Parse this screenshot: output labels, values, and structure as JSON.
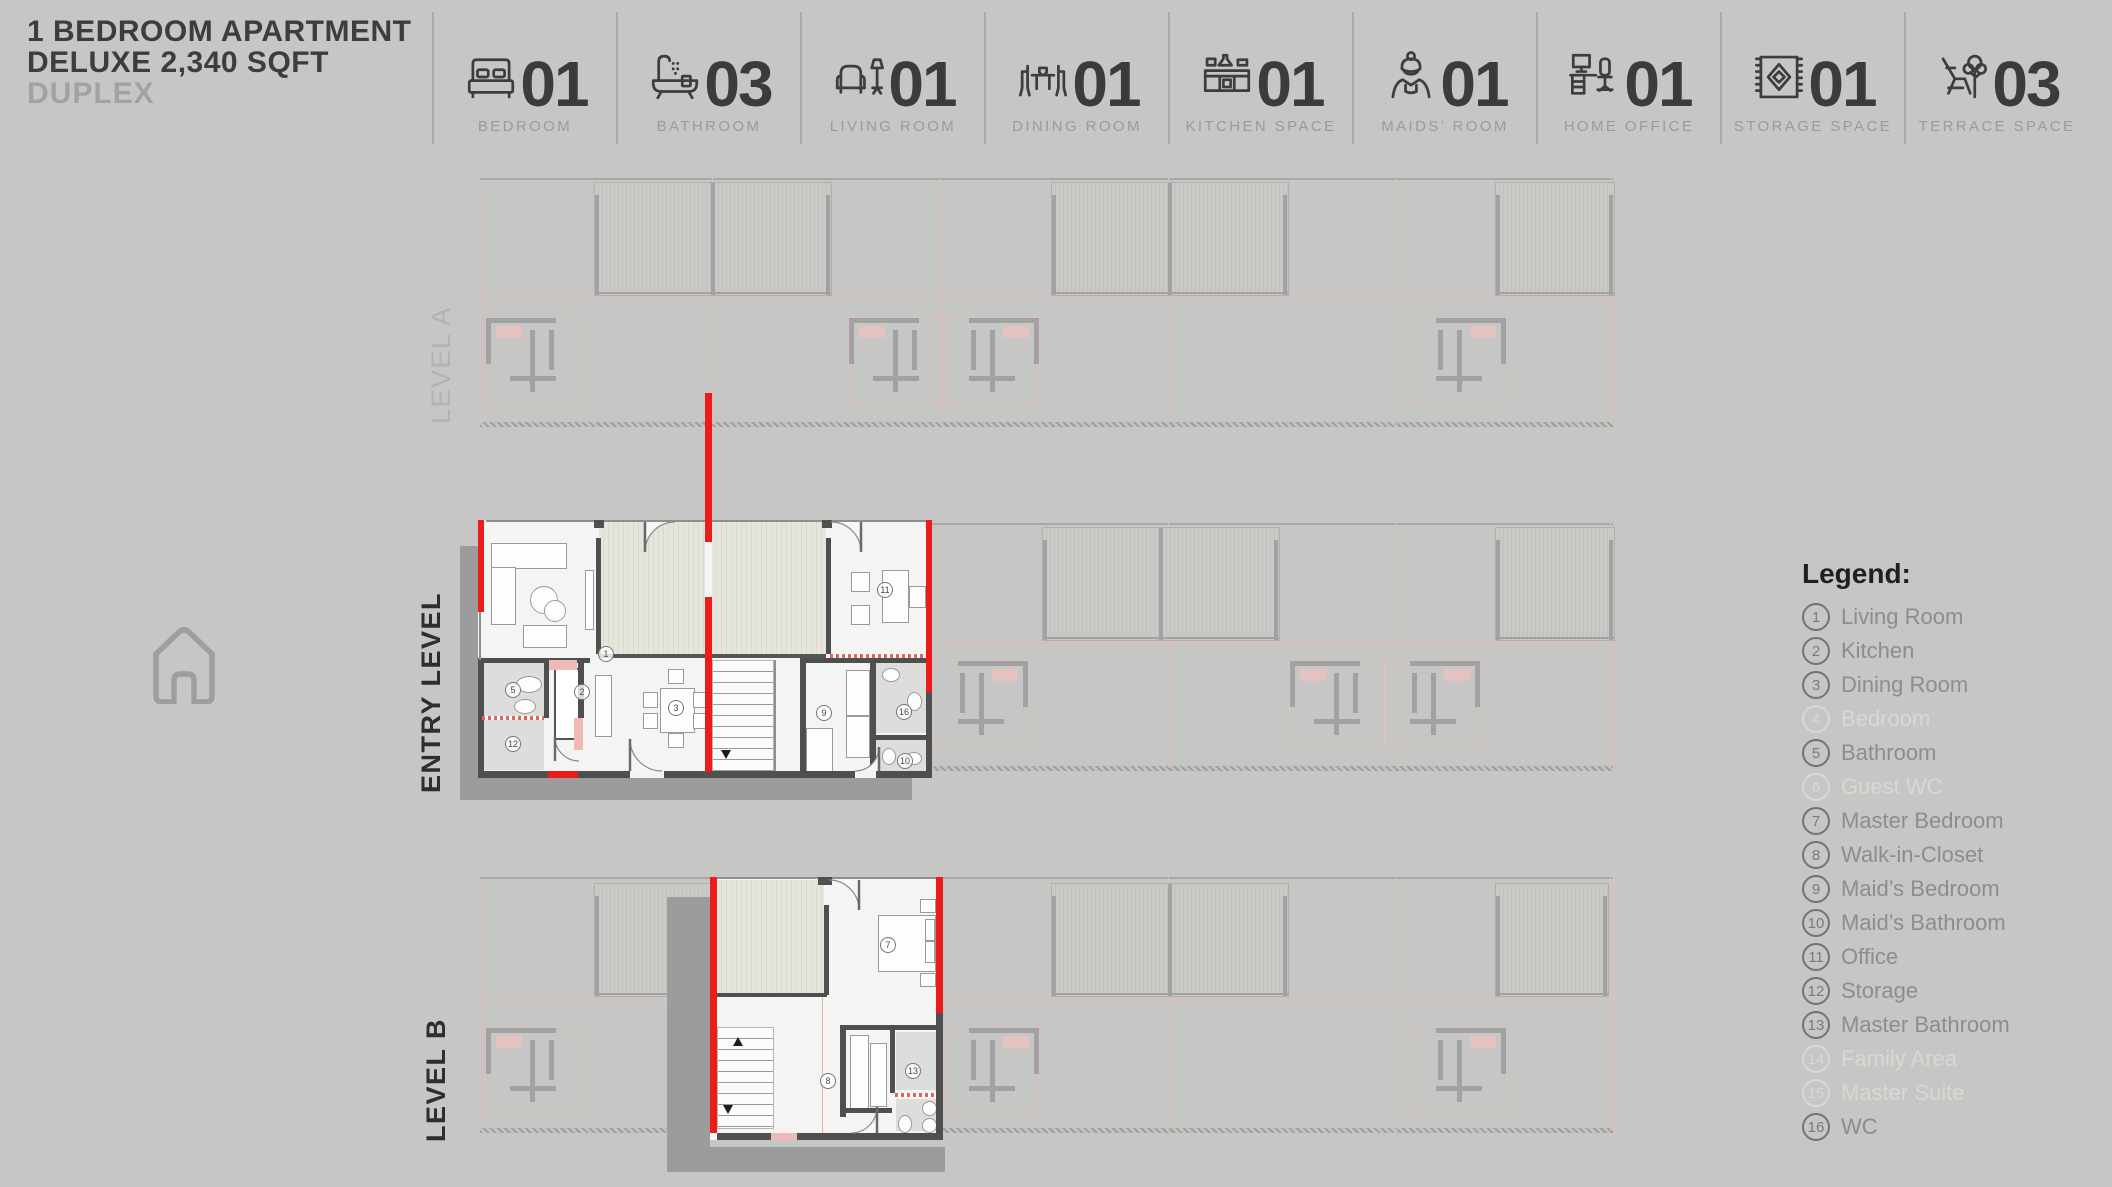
{
  "header": {
    "title_line1": "1 BEDROOM APARTMENT",
    "title_line2": "DELUXE 2,340 SQFT",
    "title_line3": "DUPLEX",
    "stats": [
      {
        "icon": "bed-icon",
        "count": "01",
        "label": "BEDROOM"
      },
      {
        "icon": "bathtub-icon",
        "count": "03",
        "label": "BATHROOM"
      },
      {
        "icon": "armchair-icon",
        "count": "01",
        "label": "LIVING ROOM"
      },
      {
        "icon": "dining-icon",
        "count": "01",
        "label": "DINING ROOM"
      },
      {
        "icon": "kitchen-icon",
        "count": "01",
        "label": "KITCHEN SPACE"
      },
      {
        "icon": "maid-icon",
        "count": "01",
        "label": "MAIDS’ ROOM"
      },
      {
        "icon": "desk-icon",
        "count": "01",
        "label": "HOME OFFICE"
      },
      {
        "icon": "rug-icon",
        "count": "01",
        "label": "STORAGE SPACE"
      },
      {
        "icon": "terrace-icon",
        "count": "03",
        "label": "TERRACE SPACE"
      }
    ]
  },
  "levels": {
    "level_a": "LEVEL A",
    "entry": "ENTRY LEVEL",
    "level_b": "LEVEL B"
  },
  "legend": {
    "heading": "Legend:",
    "items": [
      {
        "num": "1",
        "label": "Living Room",
        "faded": false
      },
      {
        "num": "2",
        "label": "Kitchen",
        "faded": false
      },
      {
        "num": "3",
        "label": "Dining Room",
        "faded": false
      },
      {
        "num": "4",
        "label": "Bedroom",
        "faded": true
      },
      {
        "num": "5",
        "label": "Bathroom",
        "faded": false
      },
      {
        "num": "6",
        "label": "Guest WC",
        "faded": true
      },
      {
        "num": "7",
        "label": "Master Bedroom",
        "faded": false
      },
      {
        "num": "8",
        "label": "Walk-in-Closet",
        "faded": false
      },
      {
        "num": "9",
        "label": "Maid’s Bedroom",
        "faded": false
      },
      {
        "num": "10",
        "label": "Maid’s Bathroom",
        "faded": false
      },
      {
        "num": "11",
        "label": "Office",
        "faded": false
      },
      {
        "num": "12",
        "label": "Storage",
        "faded": false
      },
      {
        "num": "13",
        "label": "Master Bathroom",
        "faded": false
      },
      {
        "num": "14",
        "label": "Family Area",
        "faded": true
      },
      {
        "num": "15",
        "label": "Master Suite",
        "faded": true
      },
      {
        "num": "16",
        "label": "WC",
        "faded": false
      }
    ]
  },
  "plan": {
    "entry_rooms": [
      "1",
      "2",
      "3",
      "5",
      "9",
      "10",
      "11",
      "12",
      "16"
    ],
    "level_b_rooms": [
      "7",
      "8",
      "13"
    ]
  },
  "colors": {
    "accent_red": "#ee1b1b",
    "wall_dark": "#4f4f4f",
    "terrace_beige": "#e4e4da",
    "background_gray": "#c6c6c5",
    "faded_pink": "#e2bcba"
  }
}
